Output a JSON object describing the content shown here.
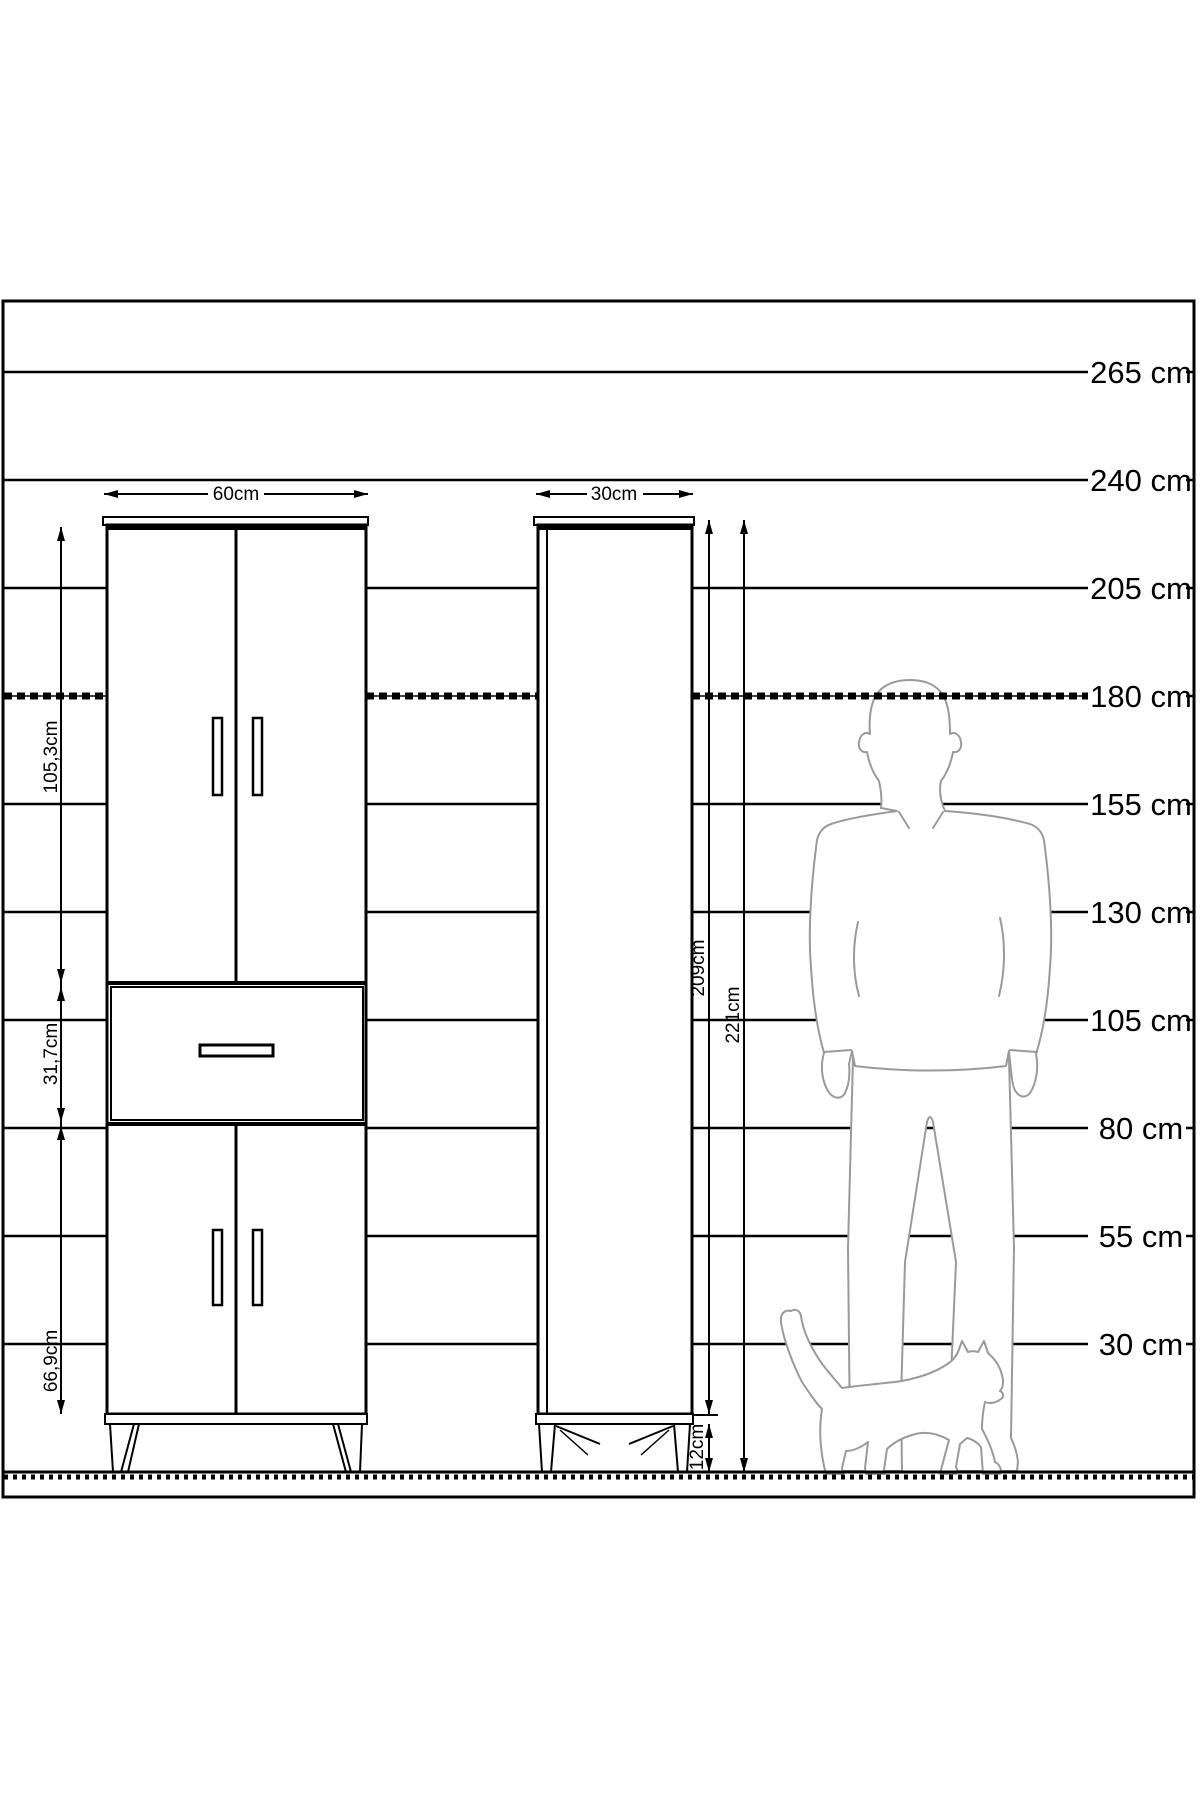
{
  "diagram": {
    "ruler": {
      "marks": [
        {
          "label": "265 cm"
        },
        {
          "label": "240 cm"
        },
        {
          "label": "205 cm"
        },
        {
          "label": "180 cm"
        },
        {
          "label": "155 cm"
        },
        {
          "label": "130 cm"
        },
        {
          "label": "105 cm"
        },
        {
          "label": "80 cm"
        },
        {
          "label": "55 cm"
        },
        {
          "label": "30 cm"
        }
      ]
    },
    "cabinet_double": {
      "width_label": "60cm",
      "upper_section_label": "105,3cm",
      "drawer_section_label": "31,7cm",
      "lower_section_label": "66,9cm"
    },
    "cabinet_tall": {
      "width_label": "30cm",
      "body_height_label": "209cm",
      "total_height_label": "221cm",
      "leg_height_label": "12cm"
    },
    "icons": {
      "man": "male-silhouette",
      "cat": "cat-silhouette"
    },
    "colors": {
      "line": "#000000",
      "figure_outline": "#9a9a9a",
      "background": "#ffffff"
    }
  }
}
